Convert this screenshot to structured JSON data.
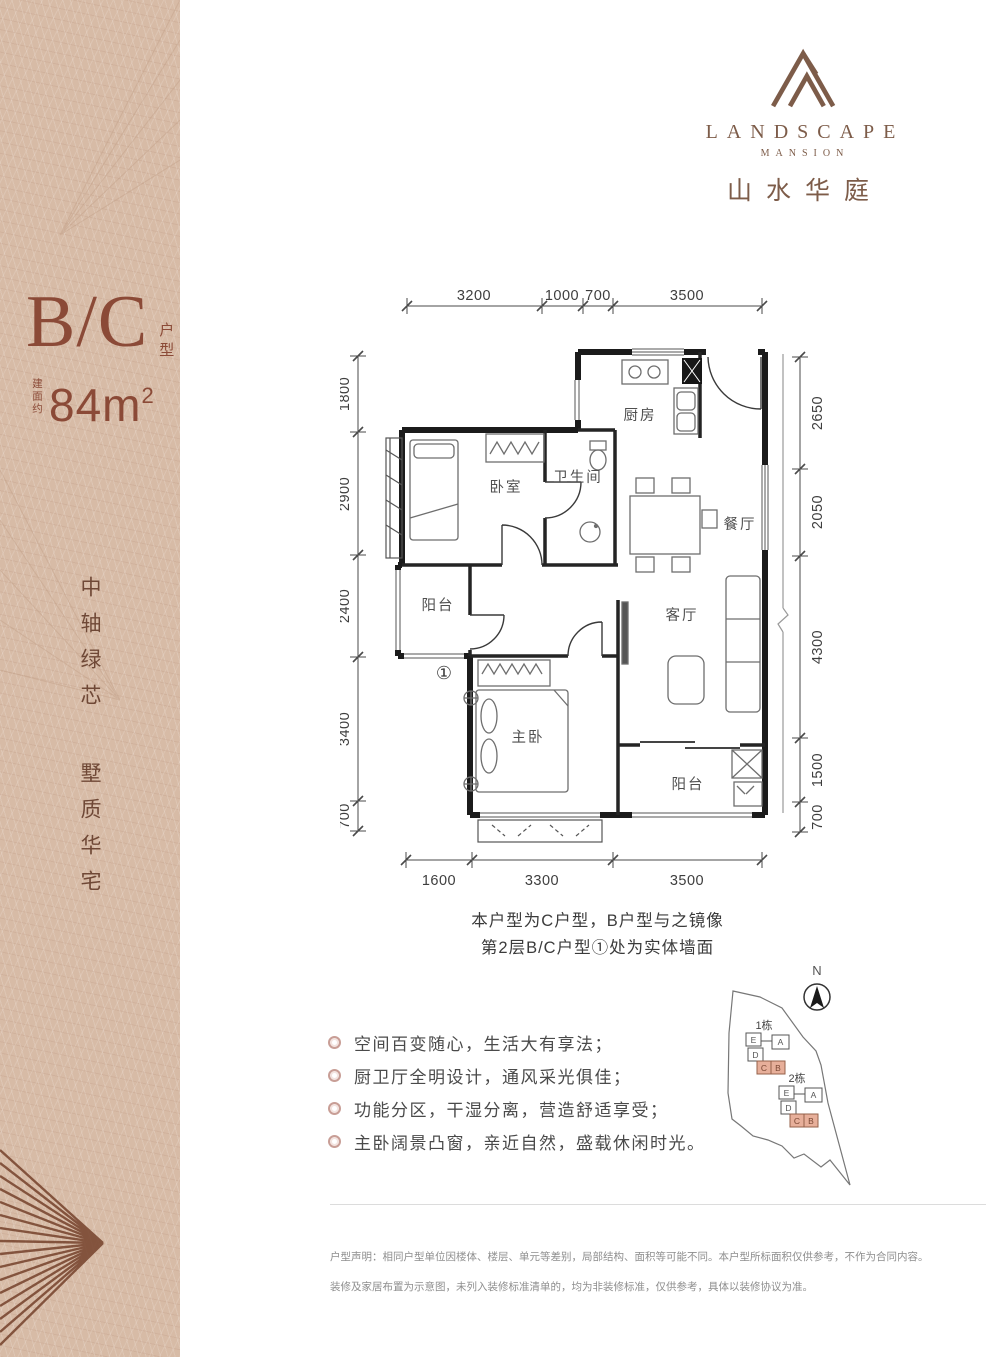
{
  "logo": {
    "brand": "LANDSCAPE",
    "sub": "MANSION",
    "chinese": "山水华庭"
  },
  "sidebar": {
    "unit_code": "B/C",
    "unit_type_label": "户型",
    "area_prefix": "建面约",
    "area_value": "84m",
    "area_exponent": "2",
    "slogan_line1": "中轴绿芯",
    "slogan_line2": "墅质华宅"
  },
  "floorplan": {
    "dims_top": [
      "3200",
      "1000",
      "700",
      "3500"
    ],
    "dims_left": [
      "1800",
      "2900",
      "2400",
      "3400",
      "700"
    ],
    "dims_right": [
      "2650",
      "2050",
      "4300",
      "1500",
      "700"
    ],
    "dims_bottom": [
      "1600",
      "3300",
      "3500"
    ],
    "rooms": {
      "kitchen": "厨房",
      "bathroom": "卫生间",
      "bedroom": "卧室",
      "dining": "餐厅",
      "balcony_top": "阳台",
      "living": "客厅",
      "master": "主卧",
      "balcony_bottom": "阳台"
    },
    "marker": "①",
    "note_line1": "本户型为C户型，B户型与之镜像",
    "note_line2": "第2层B/C户型①处为实体墙面"
  },
  "features": [
    "空间百变随心，生活大有享法；",
    "厨卫厅全明设计，通风采光俱佳；",
    "功能分区，干湿分离，营造舒适享受；",
    "主卧阔景凸窗，亲近自然，盛载休闲时光。"
  ],
  "sitemap": {
    "north": "N",
    "building1": "1栋",
    "building2": "2栋",
    "units": [
      "E",
      "D",
      "A",
      "C",
      "B"
    ]
  },
  "disclaimer": {
    "line1": "户型声明：相同户型单位因楼体、楼层、单元等差别，局部结构、面积等可能不同。本户型所标面积仅供参考，不作为合同内容。",
    "line2": "装修及家居布置为示意图，未列入装修标准清单的，均为非装修标准，仅供参考，具体以装修协议为准。"
  }
}
